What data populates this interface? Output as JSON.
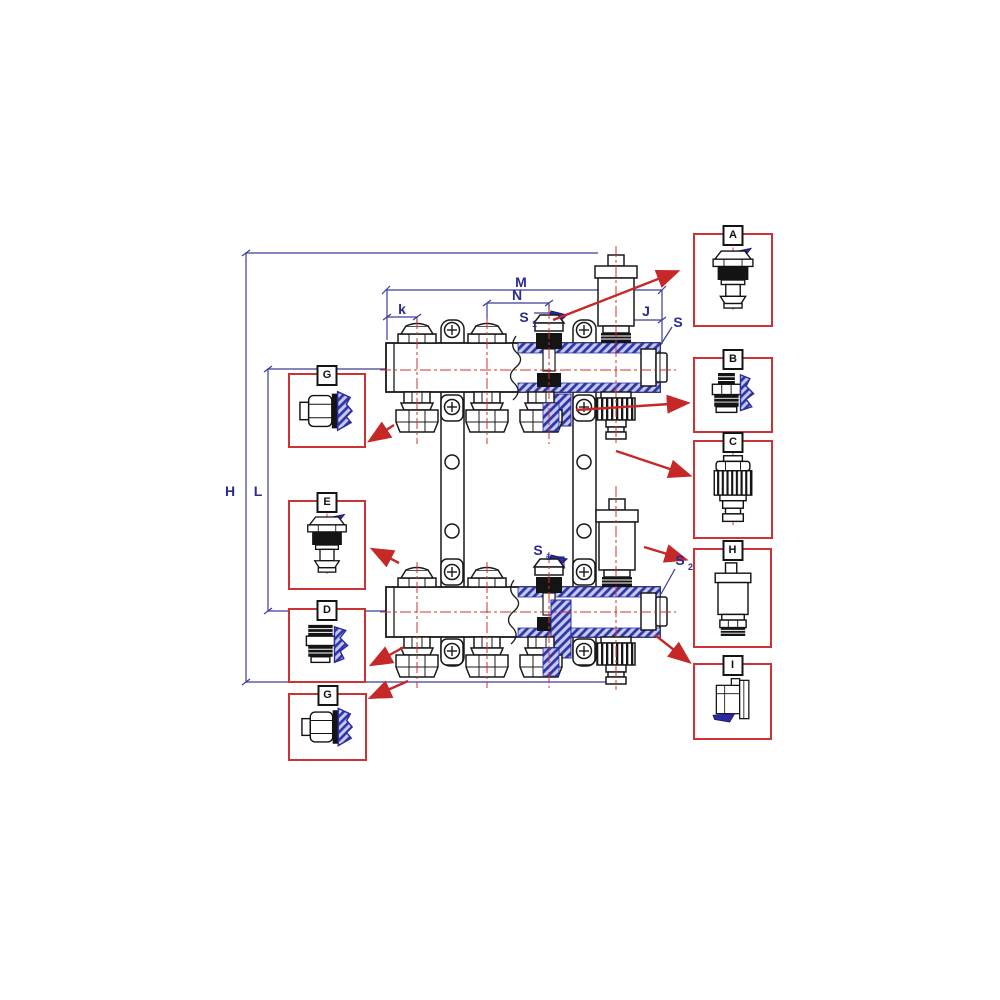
{
  "diagram": {
    "colors": {
      "dimension_line": "#3c3c9c",
      "centerline": "#cc3333",
      "arrow": "#c62828",
      "callout_border": "#cb3434",
      "section_hatch": "#3036a6",
      "drawing_line": "#1a1a1a",
      "background": "#ffffff"
    },
    "dims": {
      "H": {
        "label": "H"
      },
      "L": {
        "label": "L"
      },
      "M": {
        "label": "M"
      },
      "N": {
        "label": "N"
      },
      "k": {
        "label": "k"
      },
      "J": {
        "label": "J"
      },
      "S_end_top": {
        "label": "S"
      },
      "S1_top": {
        "label": "S",
        "sub": "1"
      },
      "S1_bottom": {
        "label": "S",
        "sub": "1"
      },
      "S2_end_bottom": {
        "label": "S",
        "sub": "2"
      }
    },
    "callouts": {
      "right": [
        {
          "id": "A",
          "part": "valve-insert"
        },
        {
          "id": "B",
          "part": "pipe-adapter"
        },
        {
          "id": "C",
          "part": "drain-valve"
        },
        {
          "id": "H",
          "part": "air-vent"
        },
        {
          "id": "I",
          "part": "end-plug"
        }
      ],
      "left": [
        {
          "id": "G",
          "part": "compression-fitting"
        },
        {
          "id": "E",
          "part": "valve-insert"
        },
        {
          "id": "D",
          "part": "pipe-adapter"
        },
        {
          "id": "G",
          "part": "compression-fitting"
        }
      ]
    }
  }
}
